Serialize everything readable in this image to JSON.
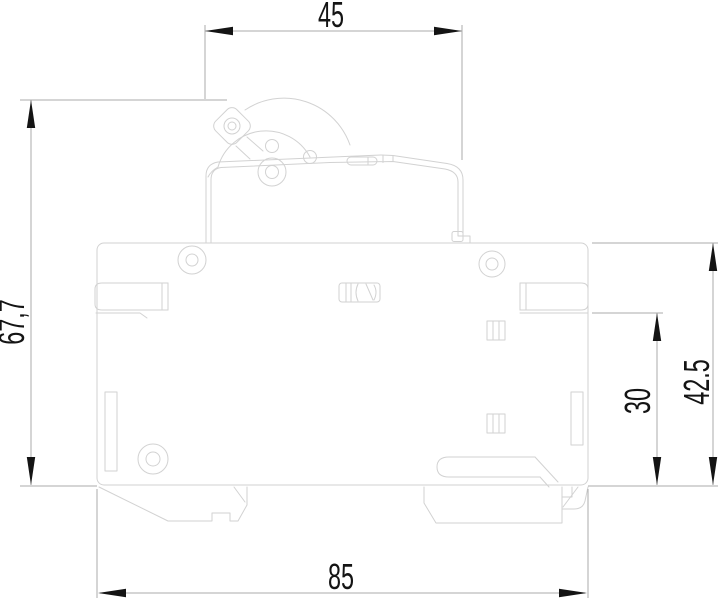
{
  "drawing": {
    "type_note": "circuit-breaker-side-view-technical-drawing",
    "background": "#ffffff",
    "colors": {
      "object_line": "#d2d2d2",
      "dim_line": "#ababab",
      "marker": "#141414",
      "label": "#141414"
    },
    "dimensions": {
      "top_width": "45",
      "overall_height": "67,7",
      "right_height": "42.5",
      "din_offset": "30",
      "bottom_width": "85"
    }
  }
}
